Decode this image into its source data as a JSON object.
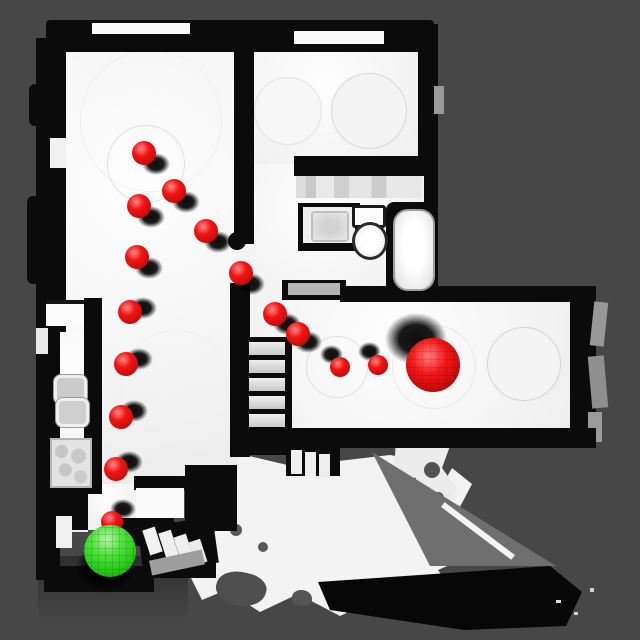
{
  "scene": {
    "type": "top-down 3D apartment scan with navigation waypoints",
    "background_color": "#474747",
    "floor_color": "#f6f6f6",
    "wall_color": "#0b0b0b"
  },
  "markers": {
    "waypoint_color": "#f21414",
    "goal_color": "#f21414",
    "start_color": "#2fd626",
    "waypoints": [
      {
        "x": 144,
        "y": 153,
        "r": 12,
        "dx": 12,
        "dy": 11
      },
      {
        "x": 174,
        "y": 191,
        "r": 12,
        "dx": 12,
        "dy": 11
      },
      {
        "x": 139,
        "y": 206,
        "r": 12,
        "dx": 12,
        "dy": 11
      },
      {
        "x": 206,
        "y": 231,
        "r": 12,
        "dx": 12,
        "dy": 11
      },
      {
        "x": 137,
        "y": 257,
        "r": 12,
        "dx": 12,
        "dy": 11
      },
      {
        "x": 241,
        "y": 273,
        "r": 12,
        "dx": 10,
        "dy": 11
      },
      {
        "x": 130,
        "y": 312,
        "r": 12,
        "dx": 13,
        "dy": -4
      },
      {
        "x": 275,
        "y": 314,
        "r": 12,
        "dx": 12,
        "dy": 10
      },
      {
        "x": 298,
        "y": 334,
        "r": 12,
        "dx": 10,
        "dy": 8
      },
      {
        "x": 126,
        "y": 364,
        "r": 12,
        "dx": 13,
        "dy": -5
      },
      {
        "x": 121,
        "y": 417,
        "r": 12,
        "dx": 13,
        "dy": -6
      },
      {
        "x": 116,
        "y": 469,
        "r": 12,
        "dx": 13,
        "dy": -7
      },
      {
        "x": 112,
        "y": 522,
        "r": 11,
        "dx": 11,
        "dy": -13
      },
      {
        "x": 340,
        "y": 367,
        "r": 10,
        "dx": -9,
        "dy": -13
      },
      {
        "x": 378,
        "y": 365,
        "r": 10,
        "dx": -9,
        "dy": -14
      }
    ],
    "goal": {
      "x": 433,
      "y": 365,
      "r": 27,
      "dx": -17,
      "dy": -26
    },
    "start": {
      "x": 110,
      "y": 551,
      "r": 26,
      "dx": -5,
      "dy": 17
    }
  }
}
